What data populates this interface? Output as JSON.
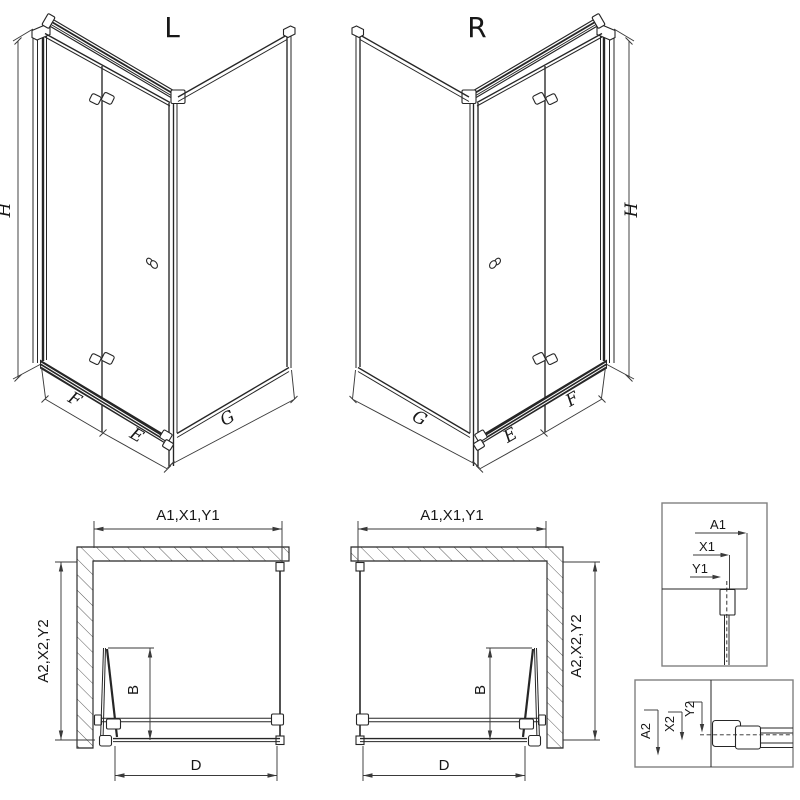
{
  "canvas": {
    "bg": "#ffffff",
    "ink": "#262626",
    "dim_ink": "#3a3a3a",
    "box_border": "#808080"
  },
  "views": {
    "iso_left": {
      "title": "L",
      "height": "H",
      "fold_panel": "F",
      "inline_panel": "E",
      "side_panel": "G"
    },
    "iso_right": {
      "title": "R",
      "height": "H",
      "fold_panel": "F",
      "inline_panel": "E",
      "side_panel": "G"
    },
    "plan_left": {
      "width": "A1,X1,Y1",
      "depth": "A2,X2,Y2",
      "door": "B",
      "entry": "D"
    },
    "plan_right": {
      "width": "A1,X1,Y1",
      "depth": "A2,X2,Y2",
      "door": "B",
      "entry": "D"
    },
    "detail_top": {
      "a": "A1",
      "x": "X1",
      "y": "Y1"
    },
    "detail_bottom": {
      "a": "A2",
      "x": "X2",
      "y": "Y2"
    }
  }
}
